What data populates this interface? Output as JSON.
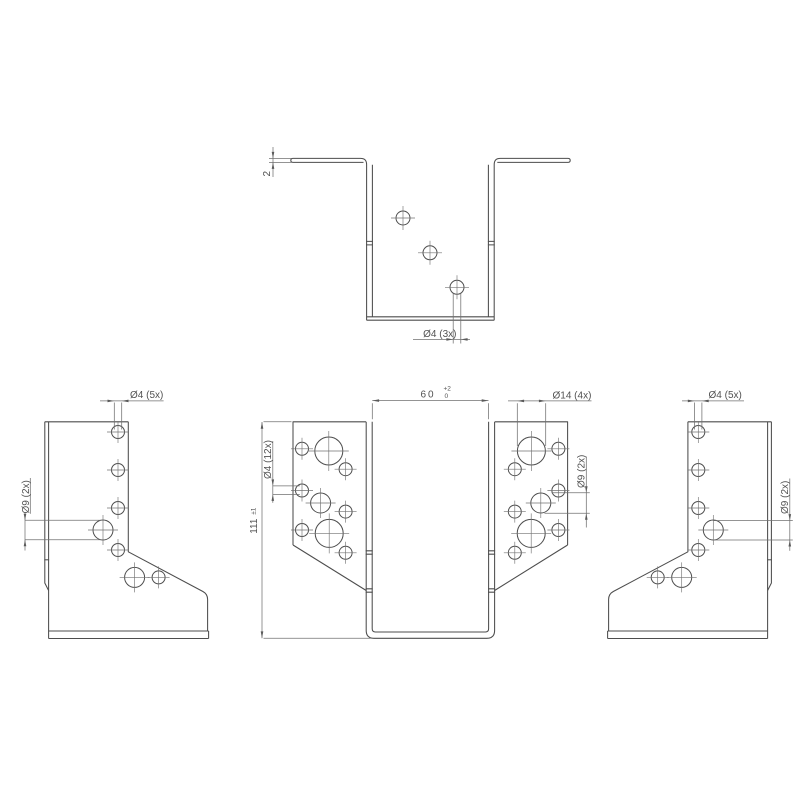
{
  "colors": {
    "background": "#ffffff",
    "edge_line": "#4d4d4d",
    "dimension_line": "#707070",
    "text": "#525252"
  },
  "views": {
    "top": {
      "thickness": "2",
      "holes_small": "Ø4 (3x)"
    },
    "left_side": {
      "holes_small": "Ø4 (5x)",
      "holes_large": "Ø9 (2x)"
    },
    "front": {
      "width": "60",
      "width_tol_upper": "+2",
      "width_tol_lower": "0",
      "height": "111",
      "height_tol": "±1",
      "holes_small": "Ø4 (12x)",
      "holes_large": "Ø14 (4x)",
      "holes_medium": "Ø9 (2x)"
    },
    "right_side": {
      "holes_small": "Ø4 (5x)",
      "holes_large": "Ø9 (2x)"
    }
  }
}
